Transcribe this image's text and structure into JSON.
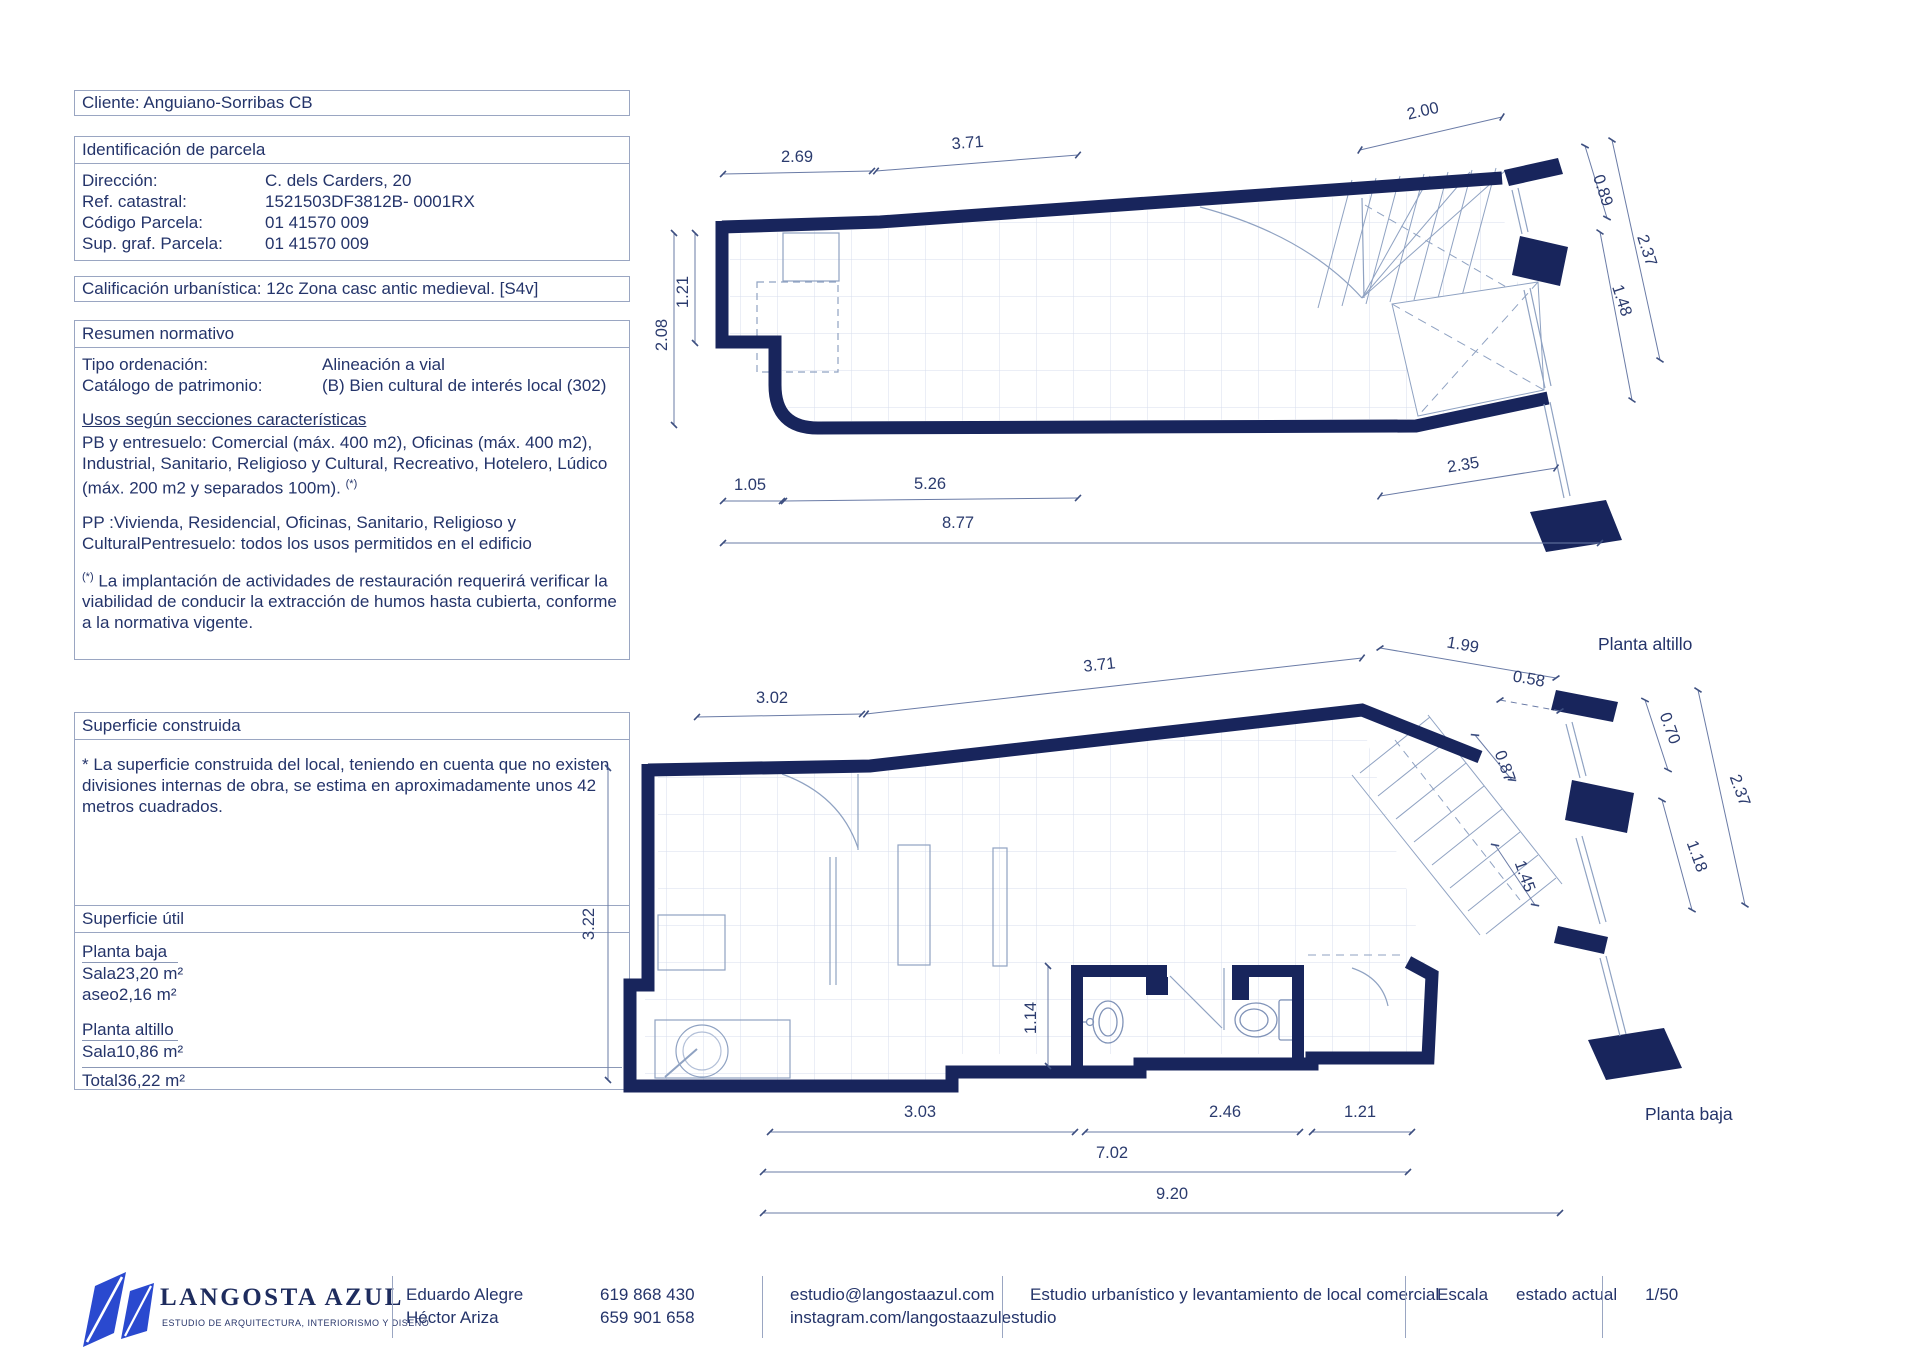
{
  "panel": {
    "cliente": "Cliente: Anguiano-Sorribas CB",
    "parcela": {
      "title": "Identificación de parcela",
      "rows": [
        {
          "label": "Dirección:",
          "value": "C. dels Carders, 20"
        },
        {
          "label": "Ref. catastral:",
          "value": "1521503DF3812B- 0001RX"
        },
        {
          "label": "Código Parcela:",
          "value": "01 41570 009"
        },
        {
          "label": "Sup. graf.  Parcela:",
          "value": "01 41570 009"
        }
      ]
    },
    "calificacion": "Calificación urbanística: 12c Zona casc antic medieval.  [S4v]",
    "resumen": {
      "title": "Resumen normativo",
      "rows": [
        {
          "label": "Tipo ordenación:",
          "value": "Alineación a vial"
        },
        {
          "label": "Catálogo de patrimonio:",
          "value": "(B) Bien cultural de interés local (302)"
        }
      ],
      "usos_title": "Usos según secciones características",
      "p1": "PB y entresuelo: Comercial (máx. 400 m2), Oficinas (máx. 400 m2), Industrial, Sanitario, Religioso y Cultural, Recreativo, Hotelero, Lúdico (máx. 200 m2 y separados 100m). ",
      "p1_sup": "(*)",
      "p2": "PP :Vivienda, Residencial, Oficinas, Sanitario, Religioso y CulturalPentresuelo: todos los usos permitidos en el edificio",
      "p3_sup": "(*)",
      "p3": " La implantación de actividades de restauración requerirá verificar la viabilidad de conducir la extracción de humos hasta cubierta, conforme a la normativa vigente."
    },
    "sup_construida": {
      "title": "Superficie construida",
      "body": "*  La superficie construida del local, teniendo en cuenta que no existen divisiones internas de obra, se estima en aproximadamente unos 42 metros cuadrados."
    },
    "sup_util": {
      "title": "Superficie útil",
      "g1_name": "Planta baja",
      "g1_rows": [
        {
          "label": "Sala",
          "value": "23,20 m²"
        },
        {
          "label": "aseo",
          "value": "2,16 m²"
        }
      ],
      "g2_name": "Planta altillo",
      "g2_rows": [
        {
          "label": "Sala",
          "value": "10,86 m²"
        }
      ],
      "total_label": "Total",
      "total_value": "36,22 m²"
    }
  },
  "plans": {
    "altillo": {
      "name": "Planta altillo",
      "dims": {
        "w1": "2.69",
        "w2": "3.71",
        "w3": "2.00",
        "h1": "1.21",
        "h2": "2.08",
        "b1": "1.05",
        "b2": "5.26",
        "b3": "2.35",
        "total": "8.77",
        "r1": "0.89",
        "r2": "2.37",
        "r3": "1.48"
      }
    },
    "baja": {
      "name": "Planta baja",
      "dims": {
        "w1": "3.02",
        "w2": "3.71",
        "w3": "1.99",
        "w4": "0.58",
        "h1": "3.22",
        "i1": "1.14",
        "s1": "0.87",
        "s2": "1.45",
        "b1": "3.03",
        "b2": "2.46",
        "b3": "1.21",
        "b4": "7.02",
        "total": "9.20",
        "r1": "0.70",
        "r2": "2.37",
        "r3": "1.18"
      }
    }
  },
  "footer": {
    "brand": "LANGOSTA AZUL",
    "tagline": "ESTUDIO DE ARQUITECTURA, INTERIORISMO Y DISEÑO",
    "name1": "Eduardo Alegre",
    "name2": "Héctor Ariza",
    "phone1": "619 868 430",
    "phone2": "659 901 658",
    "email": "estudio@langostaazul.com",
    "instagram": "instagram.com/langostaazulestudio",
    "project": "Estudio urbanístico y levantamiento de local comercial",
    "escala_label": "Escala",
    "escala_state": "estado actual",
    "escala_value": "1/50"
  },
  "colors": {
    "wall_navy": "#18255c",
    "text_navy": "#24346a",
    "logo_blue": "#2a49cf",
    "thin_line": "#8fa2c2"
  }
}
